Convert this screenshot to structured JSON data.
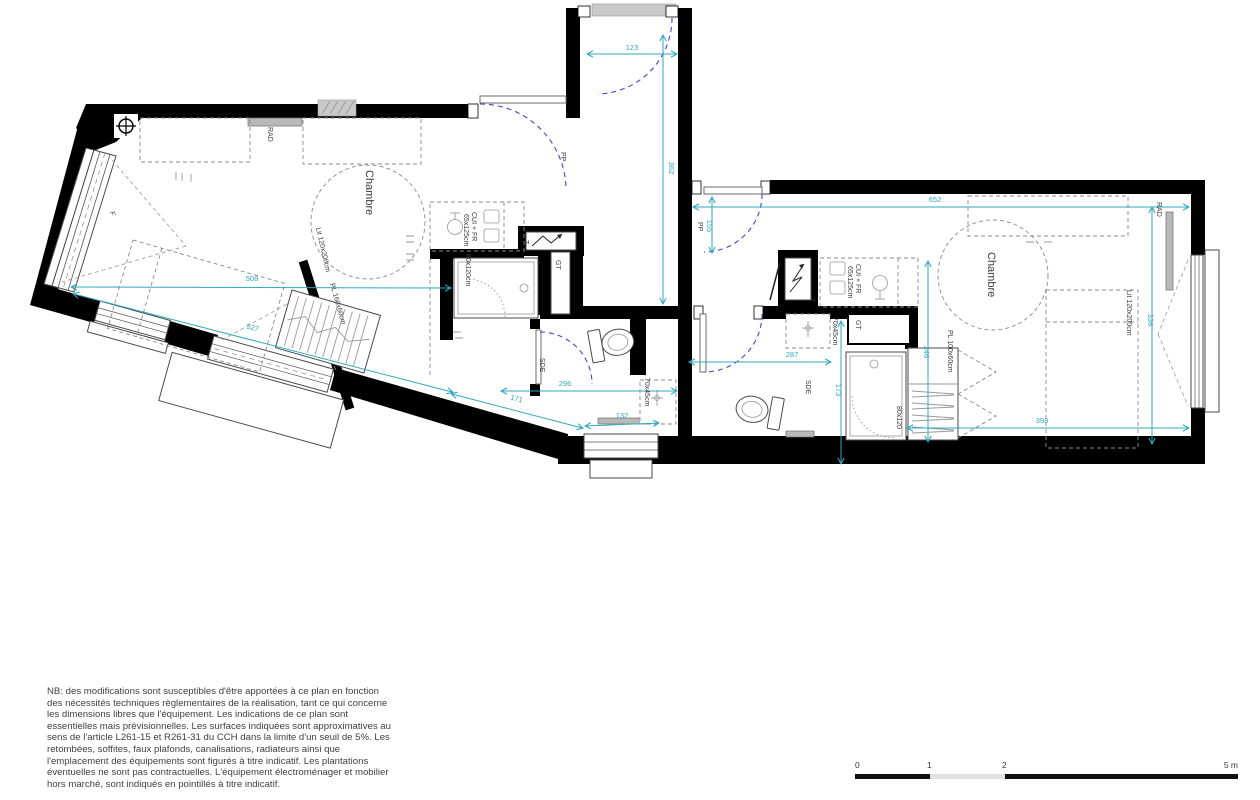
{
  "labels": {
    "left": {
      "room": "Chambre",
      "bed": "Lit 120x200cm",
      "closet": "PL 160x60cm",
      "radiator": "RAD",
      "door": "PP",
      "kitchen": "CUI + FR",
      "kitchen_size": "65x125cm",
      "shower": "80x120cm",
      "duct": "GT",
      "panel": "T",
      "bathroom": "SDE",
      "basin": "70x45cm",
      "window_mark": "F"
    },
    "right": {
      "room": "Chambre",
      "bed": "Lit 120x200cm",
      "closet": "PL 100x60cm",
      "radiator": "RAD",
      "door": "PP",
      "kitchen": "CUI + FR",
      "kitchen_size": "65x125cm",
      "shower": "80x120",
      "duct": "GT",
      "panel": "T",
      "bathroom": "SDE",
      "basin": "70x45cm"
    }
  },
  "dimensions": {
    "left": {
      "entry_width": "123",
      "entry_depth": "362",
      "room_width": "508",
      "lower_wall": "527",
      "mid_wall": "171",
      "window_width": "132",
      "sde_width": "296"
    },
    "right": {
      "room_width": "652",
      "door_width": "155",
      "sde_width": "287",
      "sde_depth": "173",
      "closet_side": "246",
      "room_depth": "336",
      "bed_wall": "398"
    }
  },
  "note": {
    "lines": [
      "NB: des modifications sont susceptibles d'être apportées à ce plan en fonction",
      "des nécessités techniques règlementaires de la réalisation, tant ce qui concerne",
      "les dimensions libres que l'équipement. Les indications de ce plan sont",
      "essentielles mais prévisionnelles. Les surfaces indiquées sont approximatives au",
      "sens de l'article L261-15 et R261-31 du CCH dans la limite d'un seuil de 5%. Les",
      "retombées, soffites, faux plafonds, canalisations, radiateurs ainsi que",
      "l'emplacement des équipements sont figurés à titre indicatif. Les plantations",
      "éventuelles ne sont pas contractuelles. L'équipement électroménager et mobilier",
      "hors marché,  sont indiqués en pointillés à titre indicatif."
    ]
  },
  "scalebar": {
    "ticks": [
      "0",
      "1",
      "2",
      "5 m"
    ]
  }
}
